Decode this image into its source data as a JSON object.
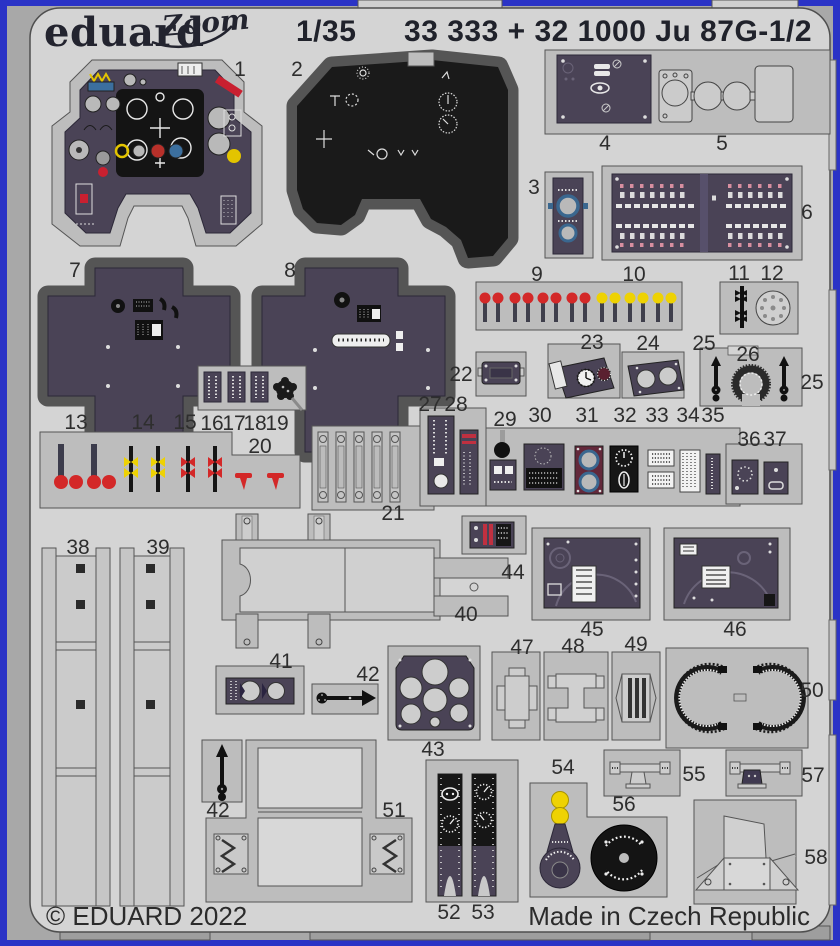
{
  "header": {
    "brand": "eduard",
    "brand_sub": "Zoom",
    "scale": "1/35",
    "title": "33 333 + 32 1000 Ju 87G-1/2"
  },
  "footer": {
    "copyright": "© EDUARD 2022",
    "origin": "Made in Czech Republic"
  },
  "colors": {
    "border_blue": "#2a33c6",
    "surround_gray": "#a8a8a8",
    "fret_gray": "#d4d4d4",
    "carrier_gray": "#bdbdbd",
    "print_purple": "#4a4356",
    "print_black": "#161616",
    "ball_red": "#d32828",
    "ball_yellow": "#eed203",
    "ring_blue": "#3a678f",
    "maroon": "#63283a",
    "metal_gray": "#cbcbcb"
  },
  "part_labels": [
    {
      "text": "1",
      "x": 240,
      "y": 76
    },
    {
      "text": "2",
      "x": 297,
      "y": 76
    },
    {
      "text": "3",
      "x": 534,
      "y": 194
    },
    {
      "text": "4",
      "x": 605,
      "y": 150
    },
    {
      "text": "5",
      "x": 722,
      "y": 150
    },
    {
      "text": "6",
      "x": 807,
      "y": 219
    },
    {
      "text": "7",
      "x": 75,
      "y": 277
    },
    {
      "text": "8",
      "x": 290,
      "y": 277
    },
    {
      "text": "9",
      "x": 537,
      "y": 281
    },
    {
      "text": "10",
      "x": 634,
      "y": 281
    },
    {
      "text": "11",
      "x": 739,
      "y": 280
    },
    {
      "text": "12",
      "x": 772,
      "y": 280
    },
    {
      "text": "13",
      "x": 76,
      "y": 429
    },
    {
      "text": "14",
      "x": 143,
      "y": 429
    },
    {
      "text": "15",
      "x": 185,
      "y": 429
    },
    {
      "text": "16",
      "x": 212,
      "y": 430
    },
    {
      "text": "17",
      "x": 234,
      "y": 430
    },
    {
      "text": "18",
      "x": 255,
      "y": 430
    },
    {
      "text": "19",
      "x": 277,
      "y": 430
    },
    {
      "text": "20",
      "x": 260,
      "y": 453
    },
    {
      "text": "21",
      "x": 393,
      "y": 520
    },
    {
      "text": "22",
      "x": 461,
      "y": 381
    },
    {
      "text": "23",
      "x": 592,
      "y": 349
    },
    {
      "text": "24",
      "x": 648,
      "y": 350
    },
    {
      "text": "25",
      "x": 704,
      "y": 350
    },
    {
      "text": "26",
      "x": 748,
      "y": 361
    },
    {
      "text": "25",
      "x": 812,
      "y": 389
    },
    {
      "text": "27",
      "x": 430,
      "y": 411
    },
    {
      "text": "28",
      "x": 456,
      "y": 411
    },
    {
      "text": "29",
      "x": 505,
      "y": 426
    },
    {
      "text": "30",
      "x": 540,
      "y": 422
    },
    {
      "text": "31",
      "x": 587,
      "y": 422
    },
    {
      "text": "32",
      "x": 625,
      "y": 422
    },
    {
      "text": "33",
      "x": 657,
      "y": 422
    },
    {
      "text": "34",
      "x": 688,
      "y": 422
    },
    {
      "text": "35",
      "x": 713,
      "y": 422
    },
    {
      "text": "36",
      "x": 749,
      "y": 446
    },
    {
      "text": "37",
      "x": 775,
      "y": 446
    },
    {
      "text": "38",
      "x": 78,
      "y": 554
    },
    {
      "text": "39",
      "x": 158,
      "y": 554
    },
    {
      "text": "40",
      "x": 466,
      "y": 621
    },
    {
      "text": "41",
      "x": 281,
      "y": 668
    },
    {
      "text": "42",
      "x": 368,
      "y": 681
    },
    {
      "text": "43",
      "x": 433,
      "y": 756
    },
    {
      "text": "44",
      "x": 513,
      "y": 579
    },
    {
      "text": "45",
      "x": 592,
      "y": 636
    },
    {
      "text": "46",
      "x": 735,
      "y": 636
    },
    {
      "text": "47",
      "x": 522,
      "y": 654
    },
    {
      "text": "48",
      "x": 573,
      "y": 653
    },
    {
      "text": "49",
      "x": 636,
      "y": 651
    },
    {
      "text": "50",
      "x": 812,
      "y": 697
    },
    {
      "text": "51",
      "x": 394,
      "y": 817
    },
    {
      "text": "42",
      "x": 218,
      "y": 817
    },
    {
      "text": "52",
      "x": 449,
      "y": 919
    },
    {
      "text": "53",
      "x": 483,
      "y": 919
    },
    {
      "text": "54",
      "x": 563,
      "y": 774
    },
    {
      "text": "55",
      "x": 694,
      "y": 781
    },
    {
      "text": "56",
      "x": 624,
      "y": 811
    },
    {
      "text": "57",
      "x": 813,
      "y": 782
    },
    {
      "text": "58",
      "x": 816,
      "y": 864
    }
  ]
}
